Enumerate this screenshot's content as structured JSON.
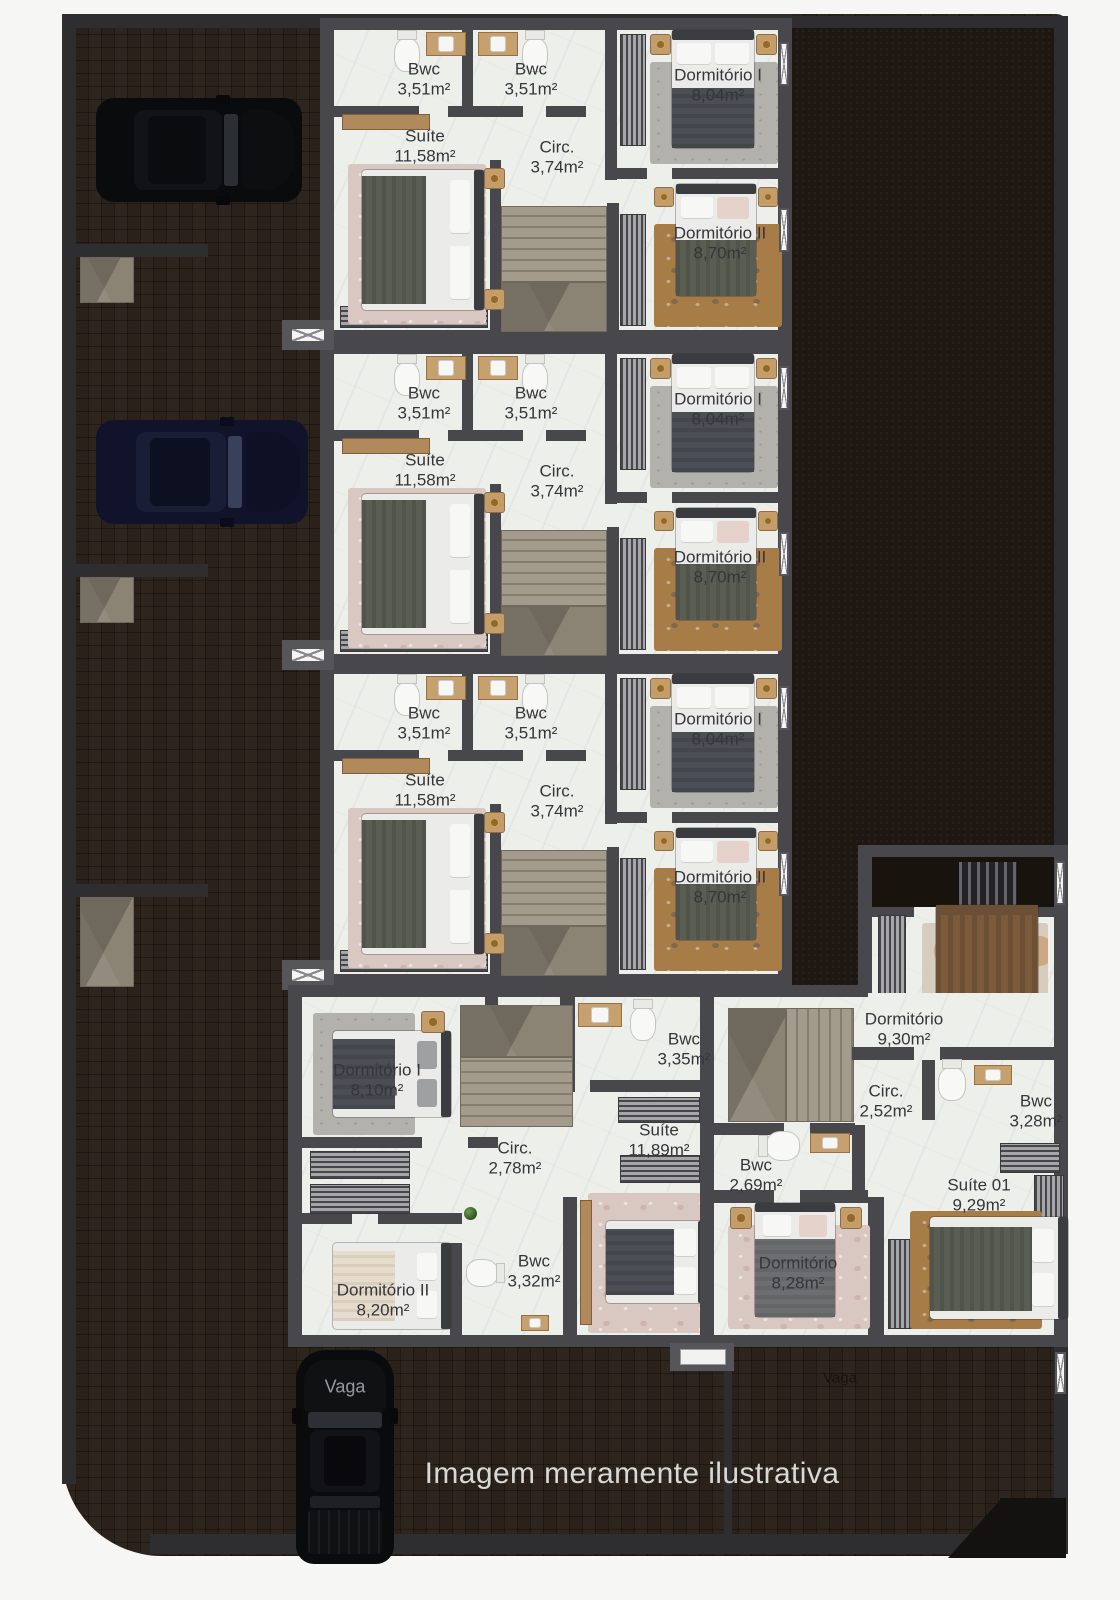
{
  "footer": {
    "caption": "Imagem meramente ilustrativa"
  },
  "parking": {
    "vaga_left": "Vaga",
    "vaga_right": "Vaga"
  },
  "upper_units": [
    {
      "bwc1": {
        "name": "Bwc",
        "area": "3,51m²"
      },
      "bwc2": {
        "name": "Bwc",
        "area": "3,51m²"
      },
      "suite": {
        "name": "Suíte",
        "area": "11,58m²"
      },
      "circ": {
        "name": "Circ.",
        "area": "3,74m²"
      },
      "dorm1": {
        "name": "Dormitório I",
        "area": "8,04m²"
      },
      "dorm2": {
        "name": "Dormitório II",
        "area": "8,70m²"
      }
    },
    {
      "bwc1": {
        "name": "Bwc",
        "area": "3,51m²"
      },
      "bwc2": {
        "name": "Bwc",
        "area": "3,51m²"
      },
      "suite": {
        "name": "Suíte",
        "area": "11,58m²"
      },
      "circ": {
        "name": "Circ.",
        "area": "3,74m²"
      },
      "dorm1": {
        "name": "Dormitório I",
        "area": "8,04m²"
      },
      "dorm2": {
        "name": "Dormitório II",
        "area": "8,70m²"
      }
    },
    {
      "bwc1": {
        "name": "Bwc",
        "area": "3,51m²"
      },
      "bwc2": {
        "name": "Bwc",
        "area": "3,51m²"
      },
      "suite": {
        "name": "Suíte",
        "area": "11,58m²"
      },
      "circ": {
        "name": "Circ.",
        "area": "3,74m²"
      },
      "dorm1": {
        "name": "Dormitório I",
        "area": "8,04m²"
      },
      "dorm2": {
        "name": "Dormitório II",
        "area": "8,70m²"
      }
    }
  ],
  "lower_left": {
    "dorm1": {
      "name": "Dormitório I",
      "area": "8,10m²"
    },
    "circ": {
      "name": "Circ.",
      "area": "2,78m²"
    },
    "bwc_top": {
      "name": "Bwc",
      "area": "3,35m²"
    },
    "suite": {
      "name": "Suíte",
      "area": "11,89m²"
    },
    "bwc": {
      "name": "Bwc",
      "area": "3,32m²"
    },
    "dorm2": {
      "name": "Dormitório II",
      "area": "8,20m²"
    }
  },
  "lower_right": {
    "dorm_top": {
      "name": "Dormitório",
      "area": "9,30m²"
    },
    "circ": {
      "name": "Circ.",
      "area": "2,52m²"
    },
    "bwc_right": {
      "name": "Bwc",
      "area": "3,28m²"
    },
    "bwc_left": {
      "name": "Bwc",
      "area": "2,69m²"
    },
    "suite": {
      "name": "Suíte 01",
      "area": "9,29m²"
    },
    "dorm_bottom": {
      "name": "Dormitório",
      "area": "8,28m²"
    }
  },
  "colors": {
    "wall": "#48484c",
    "floor": "#edefeb",
    "brick": "#2a211a",
    "soil": "#1f1812",
    "rug_orange": "#a87c46",
    "label": "#35353a",
    "caption": "#d8d8d6"
  }
}
